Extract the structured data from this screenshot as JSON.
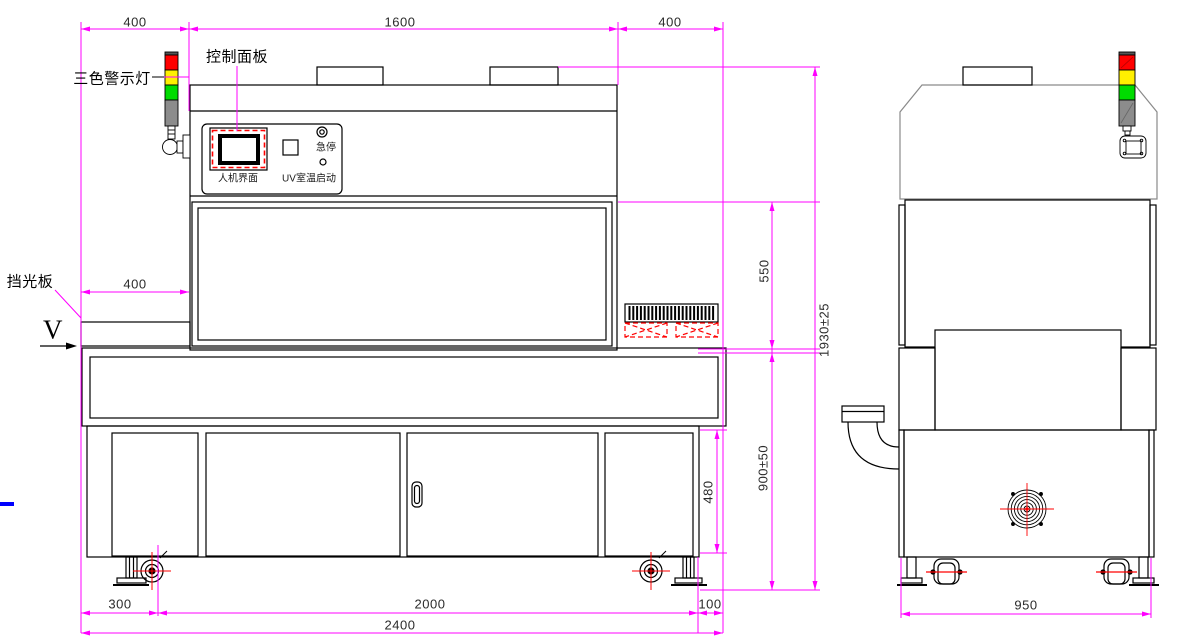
{
  "annotations": {
    "warning_light": "三色警示灯",
    "control_panel": "控制面板",
    "light_shield": "挡光板",
    "view_marker": "V"
  },
  "control_panel": {
    "hmi_label": "人机界面",
    "uv_temp_label": "UV室温",
    "estop_label": "急停",
    "start_label": "启动"
  },
  "dimensions": {
    "left_offset": "400",
    "body_width": "1600",
    "right_offset": "400",
    "shield_width": "400",
    "hood_height": "550",
    "total_height": "1930±25",
    "conveyor_height": "900±50",
    "cabinet_height": "480",
    "caster_offset": "300",
    "cabinet_span": "2000",
    "right_foot_offset": "100",
    "total_length": "2400",
    "side_width": "950"
  },
  "colors": {
    "line": "#000000",
    "dimension_line": "#FF00FF",
    "annotation_red": "#FF0000",
    "warning_red": "#FF0000",
    "warning_yellow": "#FFF000",
    "warning_green": "#00DC00",
    "warning_gray": "#8C8C8C",
    "accent_blue": "#0000FE"
  }
}
